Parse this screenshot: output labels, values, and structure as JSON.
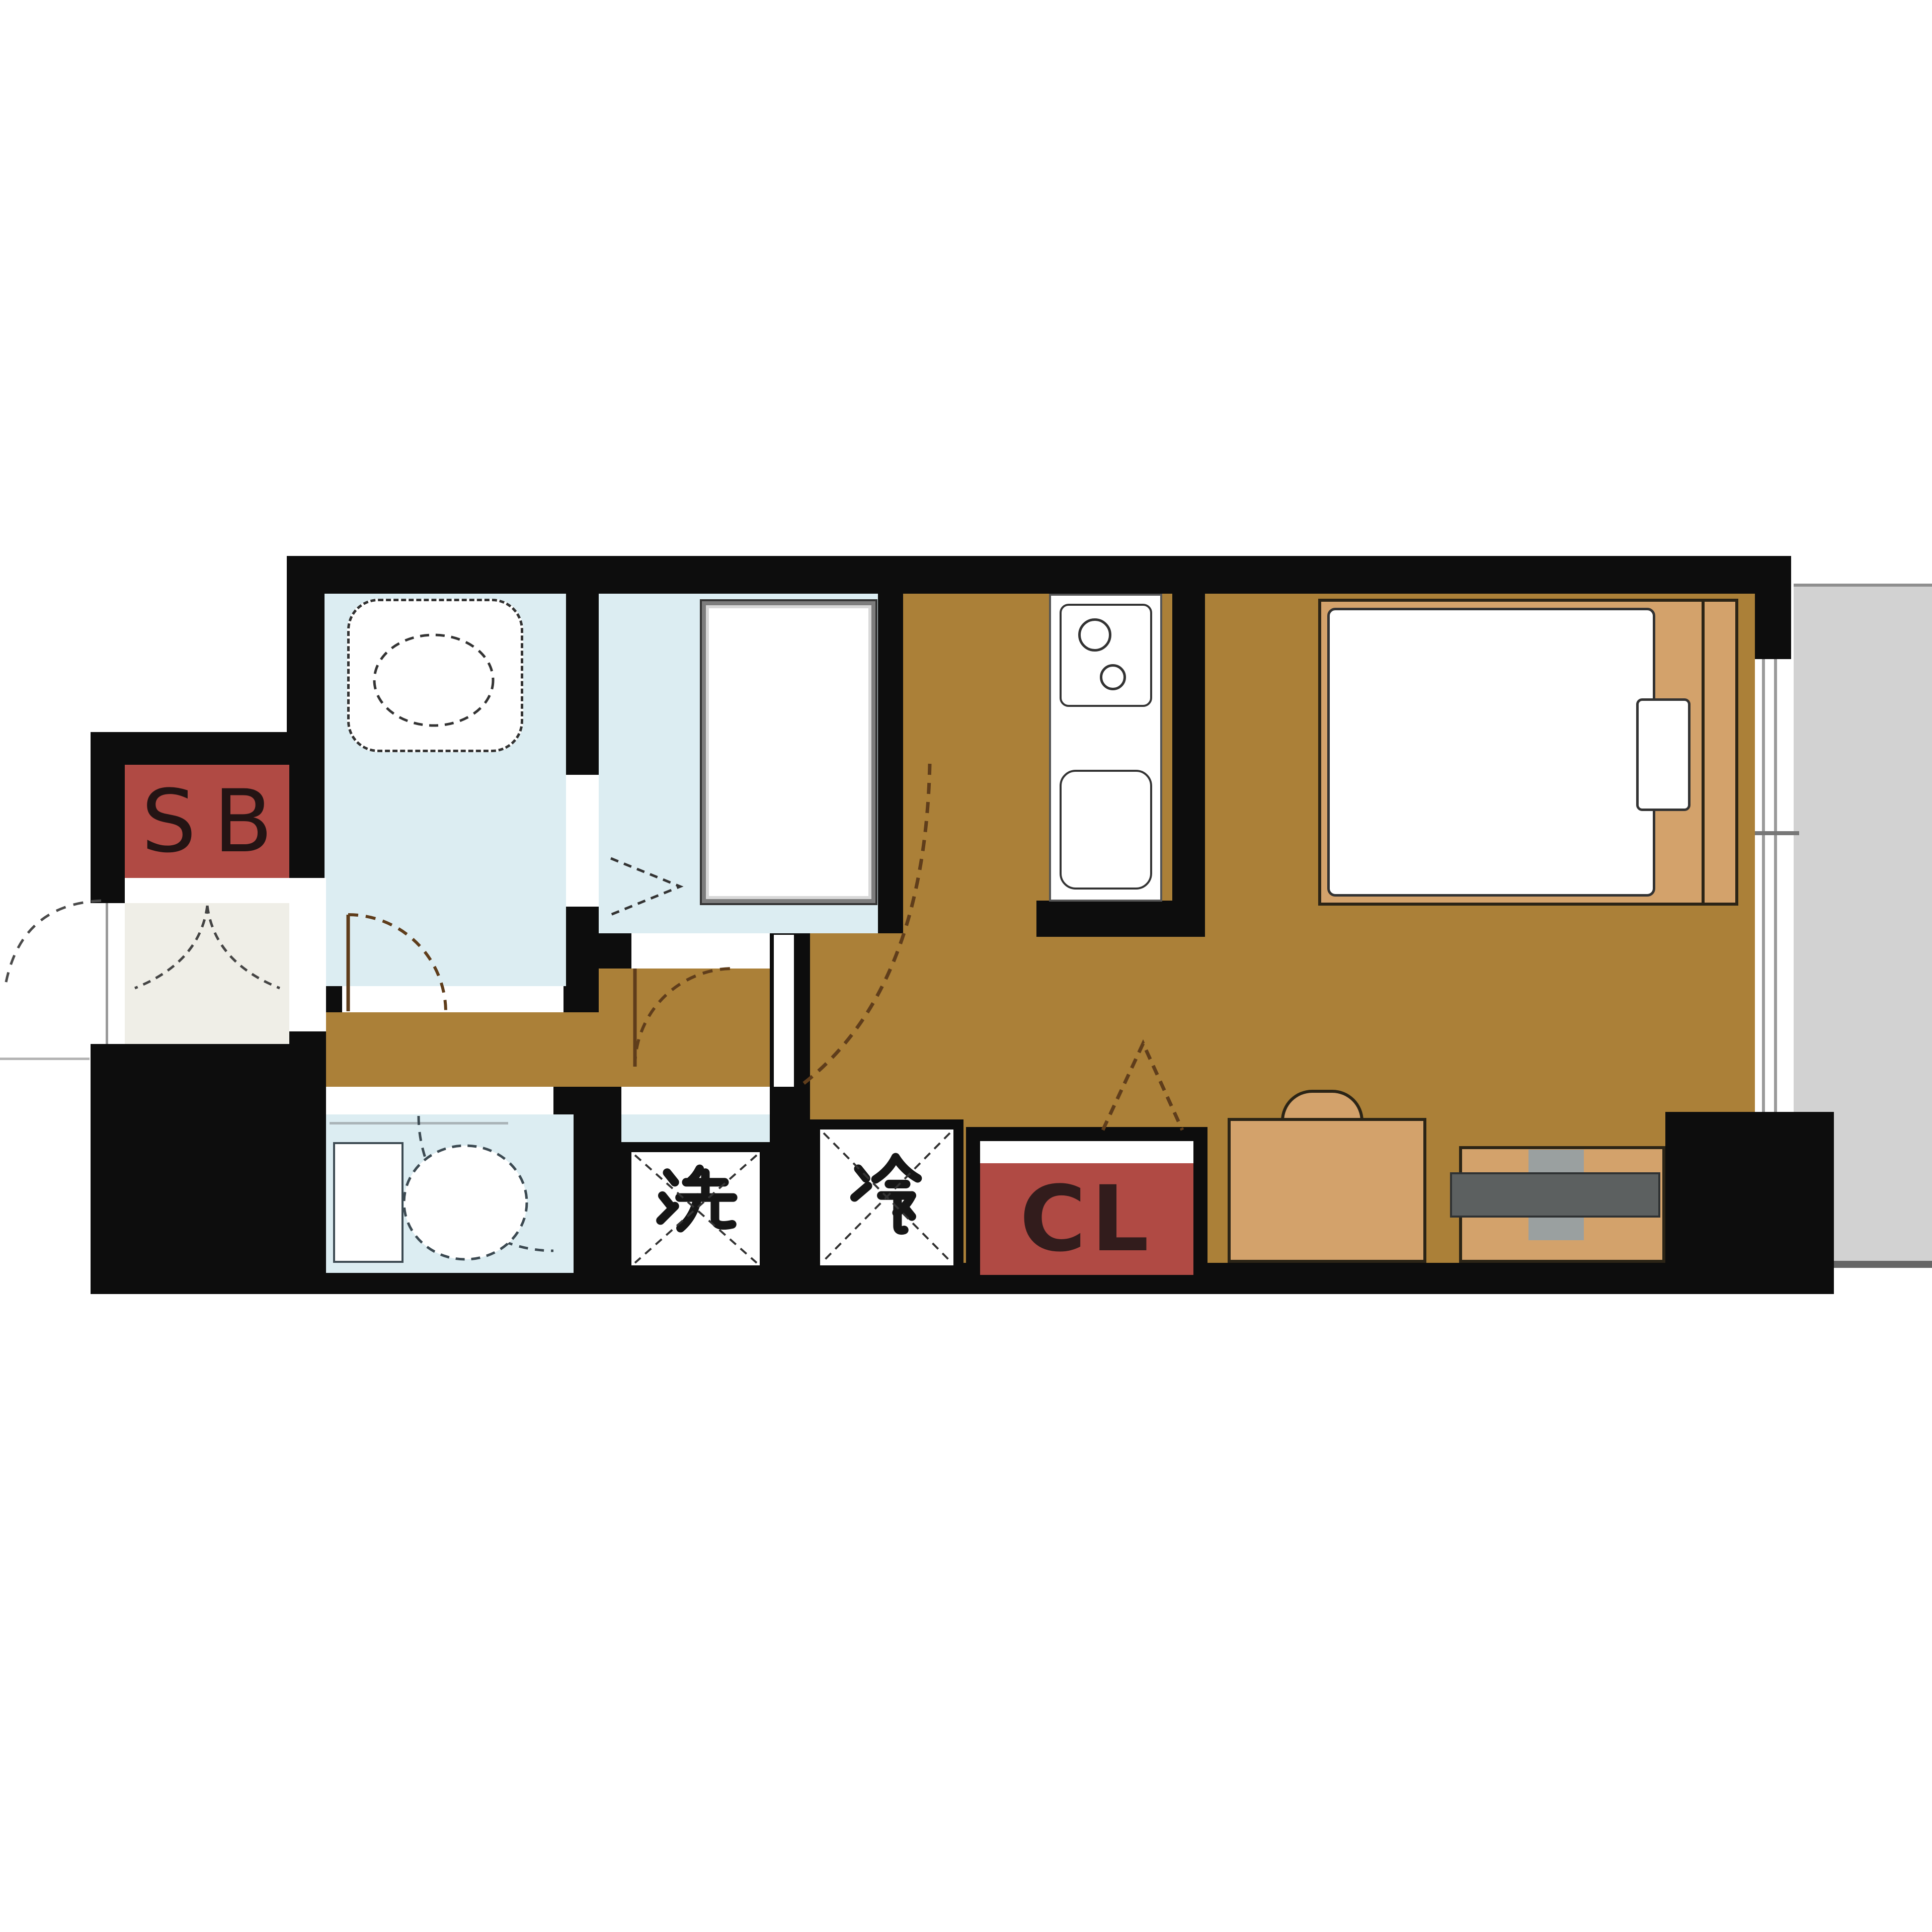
{
  "plan": {
    "type": "apartment-floor-plan",
    "labels": {
      "shoe_box": "SB",
      "closet": "CL",
      "washing_machine": "洗",
      "refrigerator": "冷"
    },
    "rooms": [
      "entrance",
      "bathroom",
      "washroom",
      "hallway",
      "toilet",
      "kitchen",
      "living-room",
      "balcony"
    ],
    "fixtures": [
      "bathtub",
      "shower-unit",
      "toilet-bowl",
      "kitchen-stove",
      "kitchen-sink",
      "bed",
      "pillow",
      "desk-chair",
      "tv-board",
      "tv",
      "sliding-window",
      "folding-door",
      "door-swing-arcs"
    ],
    "colors": {
      "wall": "#0d0d0d",
      "floor": "#ab8038",
      "wet": "#dcedf2",
      "entrance": "#efeee7",
      "cabinet-red": "#b04a44",
      "furniture": "#d3a26b",
      "furniture-border": "#2b2416",
      "balcony": "#d2d2d2",
      "balcony-edge": "#8f8f8f",
      "balcony-edge-dark": "#666666",
      "tv-screen": "#5c6060",
      "tv-stand": "#9aa0a0",
      "door-arc": "#5f3d1b",
      "fixture-line": "#333333",
      "glass": "#9a9a9a",
      "label-dark": "#241414",
      "cl-text": "#321c1c"
    }
  }
}
